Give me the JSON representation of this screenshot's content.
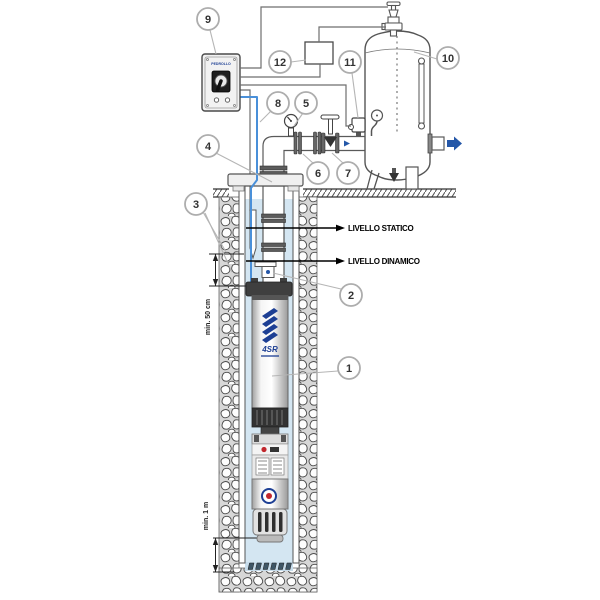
{
  "labels": {
    "static_level": "LIVELLO STATICO",
    "dynamic_level": "LIVELLO DINAMICO",
    "min_submersion": "min. 50 cm",
    "min_bottom_clearance": "min. 1 m"
  },
  "callouts": [
    {
      "number": "1"
    },
    {
      "number": "2"
    },
    {
      "number": "3"
    },
    {
      "number": "4"
    },
    {
      "number": "5"
    },
    {
      "number": "6"
    },
    {
      "number": "7"
    },
    {
      "number": "8"
    },
    {
      "number": "9"
    },
    {
      "number": "10"
    },
    {
      "number": "11"
    },
    {
      "number": "12"
    }
  ],
  "pump": {
    "model_label": "4SR"
  },
  "panel": {
    "brand_label": "PEDROLLO"
  },
  "colors": {
    "water": "#d4e6f2",
    "cable_blue": "#4a90d9",
    "flow_arrow_blue": "#2457a8",
    "logo_blue": "#1d3f94",
    "alert_red": "#c1272d"
  }
}
